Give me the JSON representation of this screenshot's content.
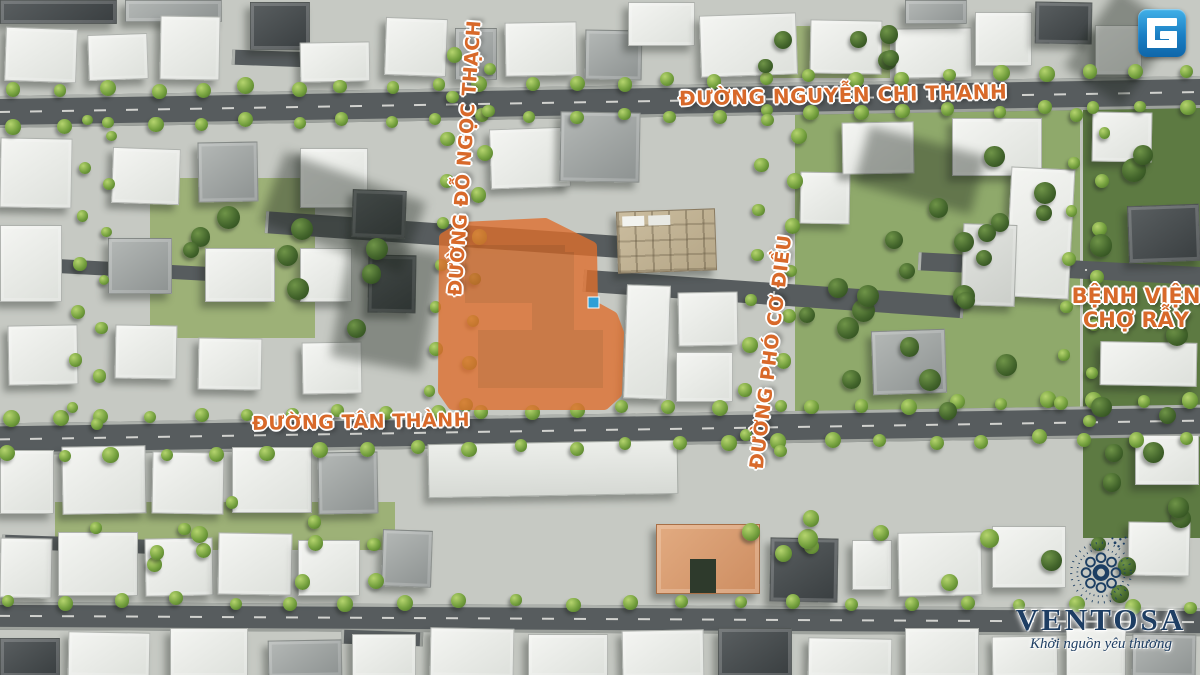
{
  "overlay_labels": {
    "street_nguyen_chi_thanh": "ĐƯỜNG NGUYỄN CHI THANH",
    "street_do_ngoc_thach": "ĐƯỜNG ĐỖ NGỌC THẠCH",
    "street_tan_thanh": "ĐƯỜNG TÂN THÀNH",
    "street_pho_co_dieu": "ĐƯỜNG PHÓ CƠ ĐIỀU",
    "hospital_line1": "BỆNH VIỆN",
    "hospital_line2": "CHỢ RẪY"
  },
  "branding": {
    "logo_letter": "G",
    "brand_name": "VENTOSA",
    "tagline": "Khởi nguồn yêu thương"
  },
  "colors": {
    "street_label": "#d8692a",
    "site_highlight": "#df6e2c",
    "brand_navy": "#1e3e63",
    "logo_blue_top": "#41b0e8",
    "logo_blue_bottom": "#0f66a9"
  }
}
